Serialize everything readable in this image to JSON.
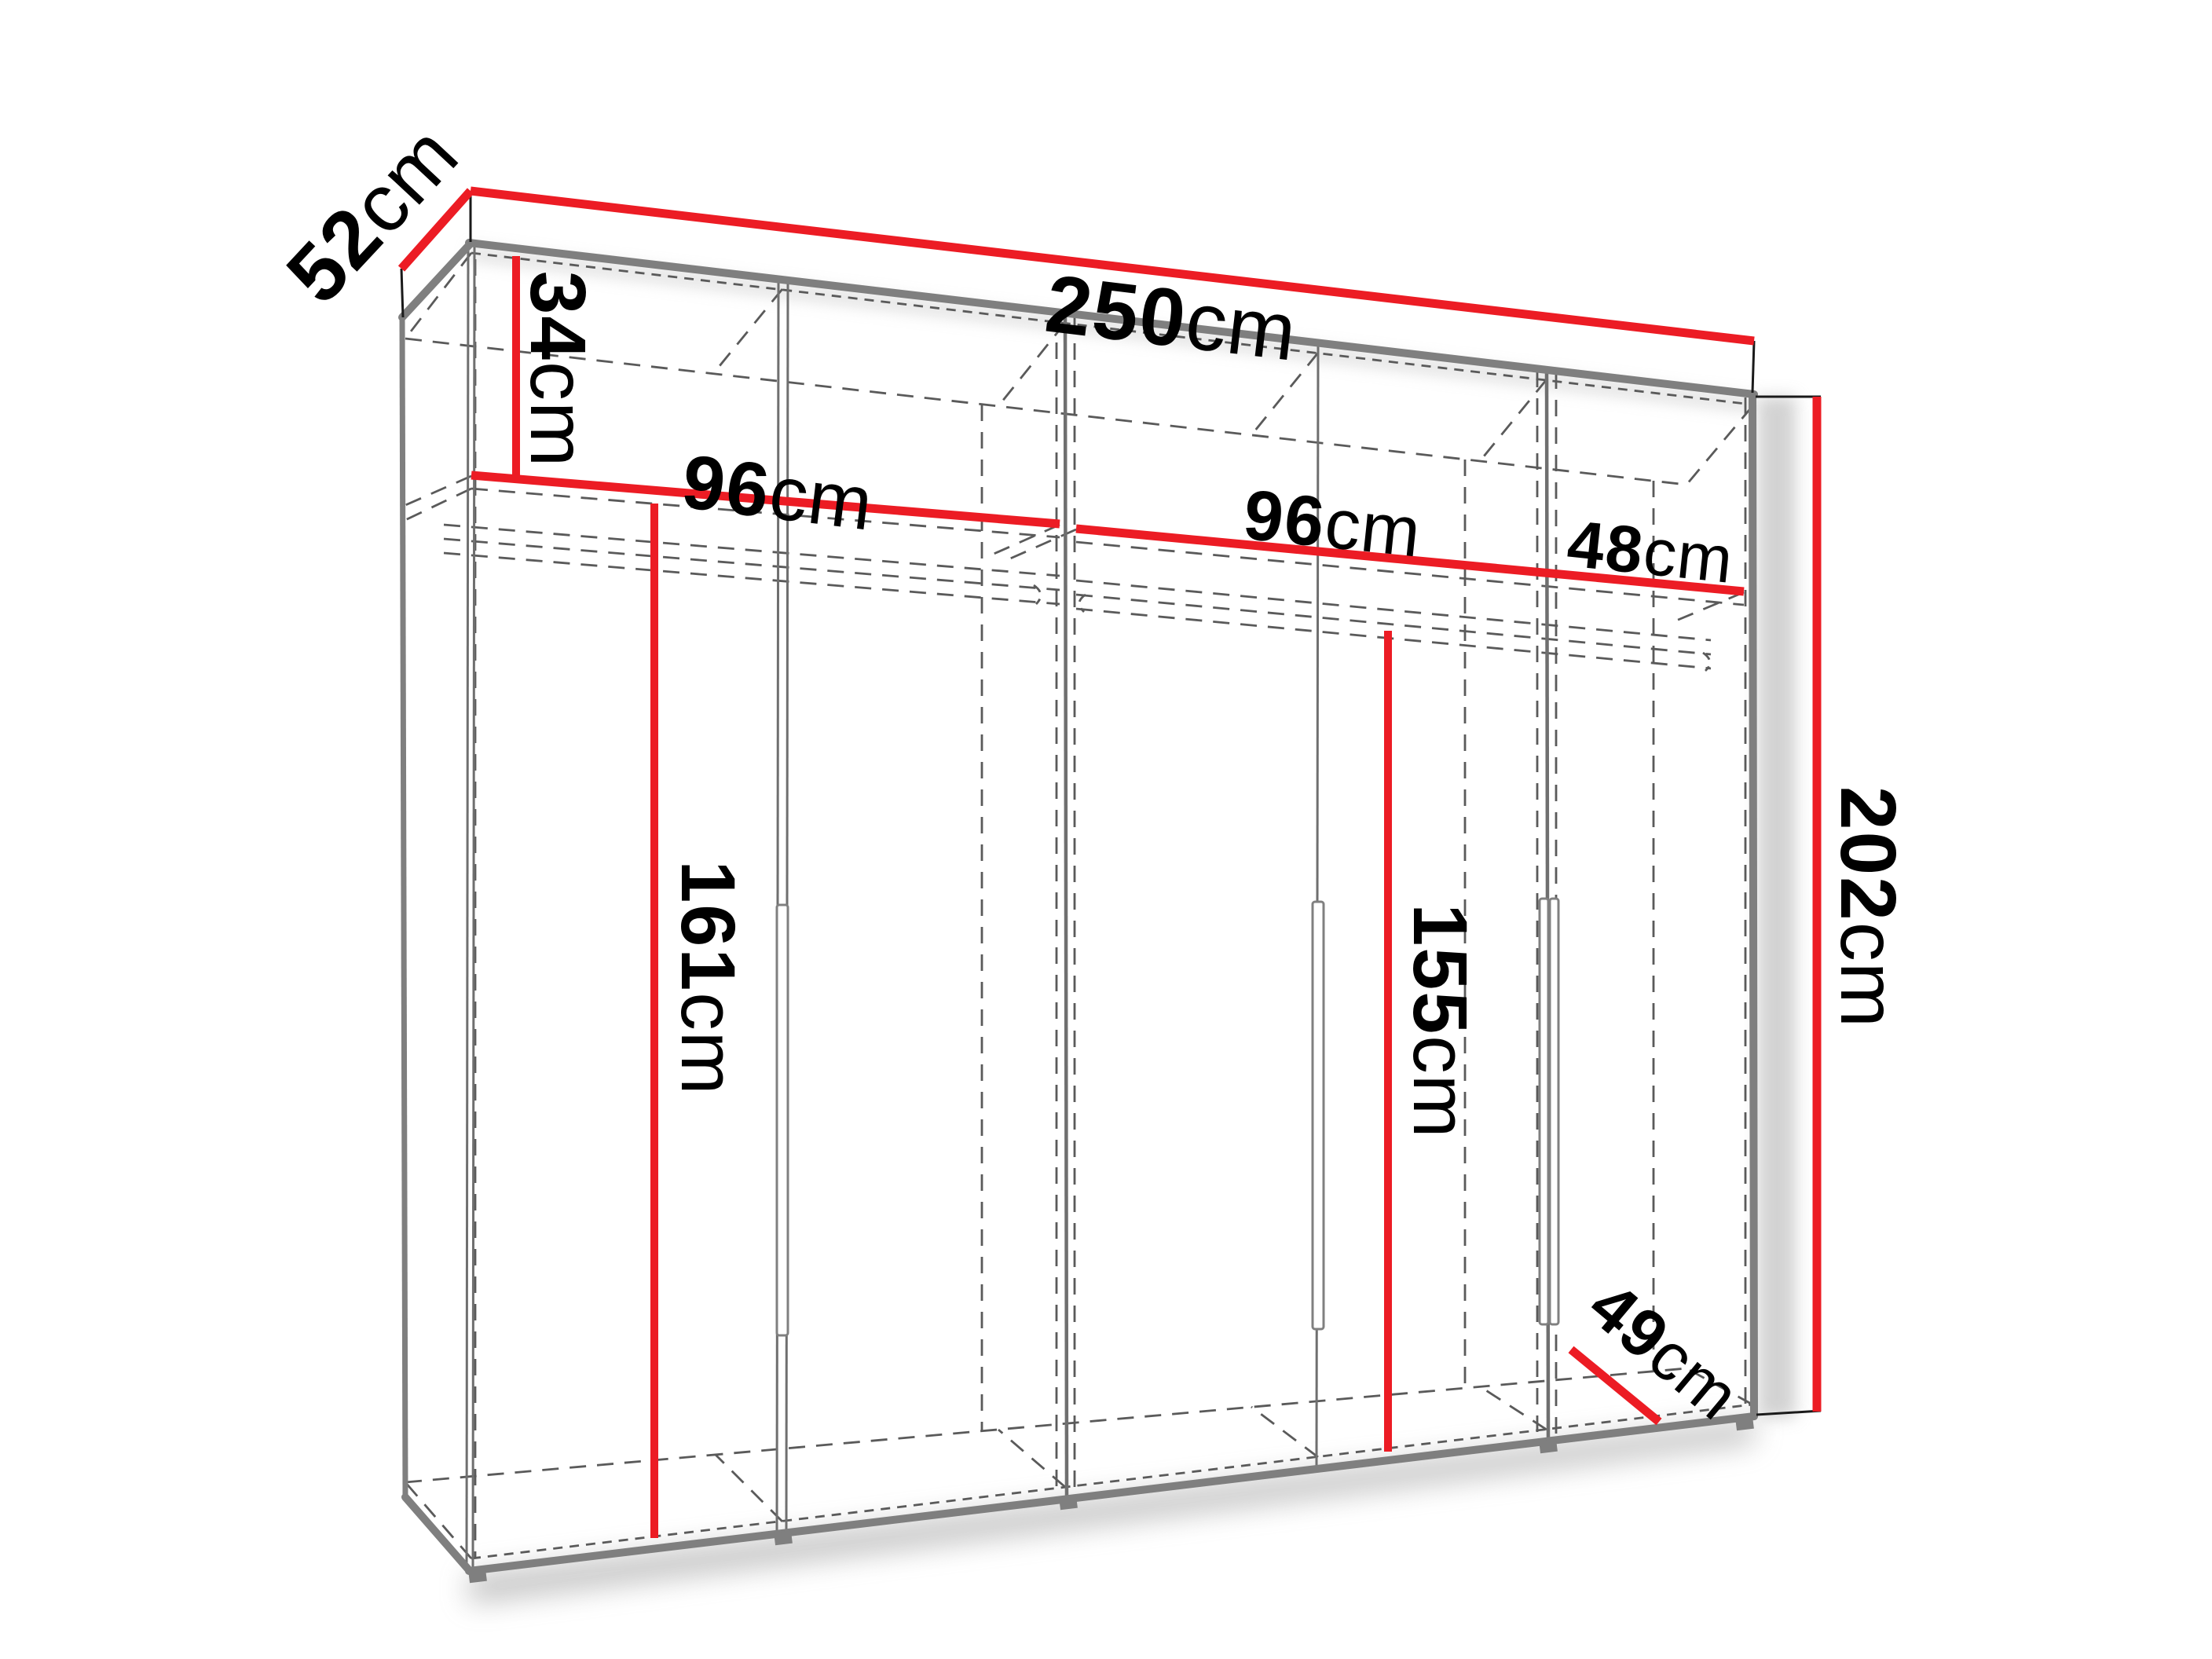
{
  "diagram": {
    "title": "wardrobe-dimension-diagram",
    "unit_system": "cm",
    "dimensions": {
      "depth": {
        "value": "52",
        "unit": "cm"
      },
      "width": {
        "value": "250",
        "unit": "cm"
      },
      "top_section": {
        "value": "34",
        "unit": "cm"
      },
      "section1_width": {
        "value": "96",
        "unit": "cm"
      },
      "section2_width": {
        "value": "96",
        "unit": "cm"
      },
      "section3_width": {
        "value": "48",
        "unit": "cm"
      },
      "height": {
        "value": "202",
        "unit": "cm"
      },
      "left_interior": {
        "value": "161",
        "unit": "cm"
      },
      "middle_interior": {
        "value": "155",
        "unit": "cm"
      },
      "bottom_depth": {
        "value": "49",
        "unit": "cm"
      }
    },
    "colors": {
      "dimension_red": "#ec1c24",
      "structure_grey": "#7f7f7f",
      "hidden_line_grey": "#5a5a5a",
      "label_black": "#000000",
      "background": "#ffffff"
    }
  }
}
